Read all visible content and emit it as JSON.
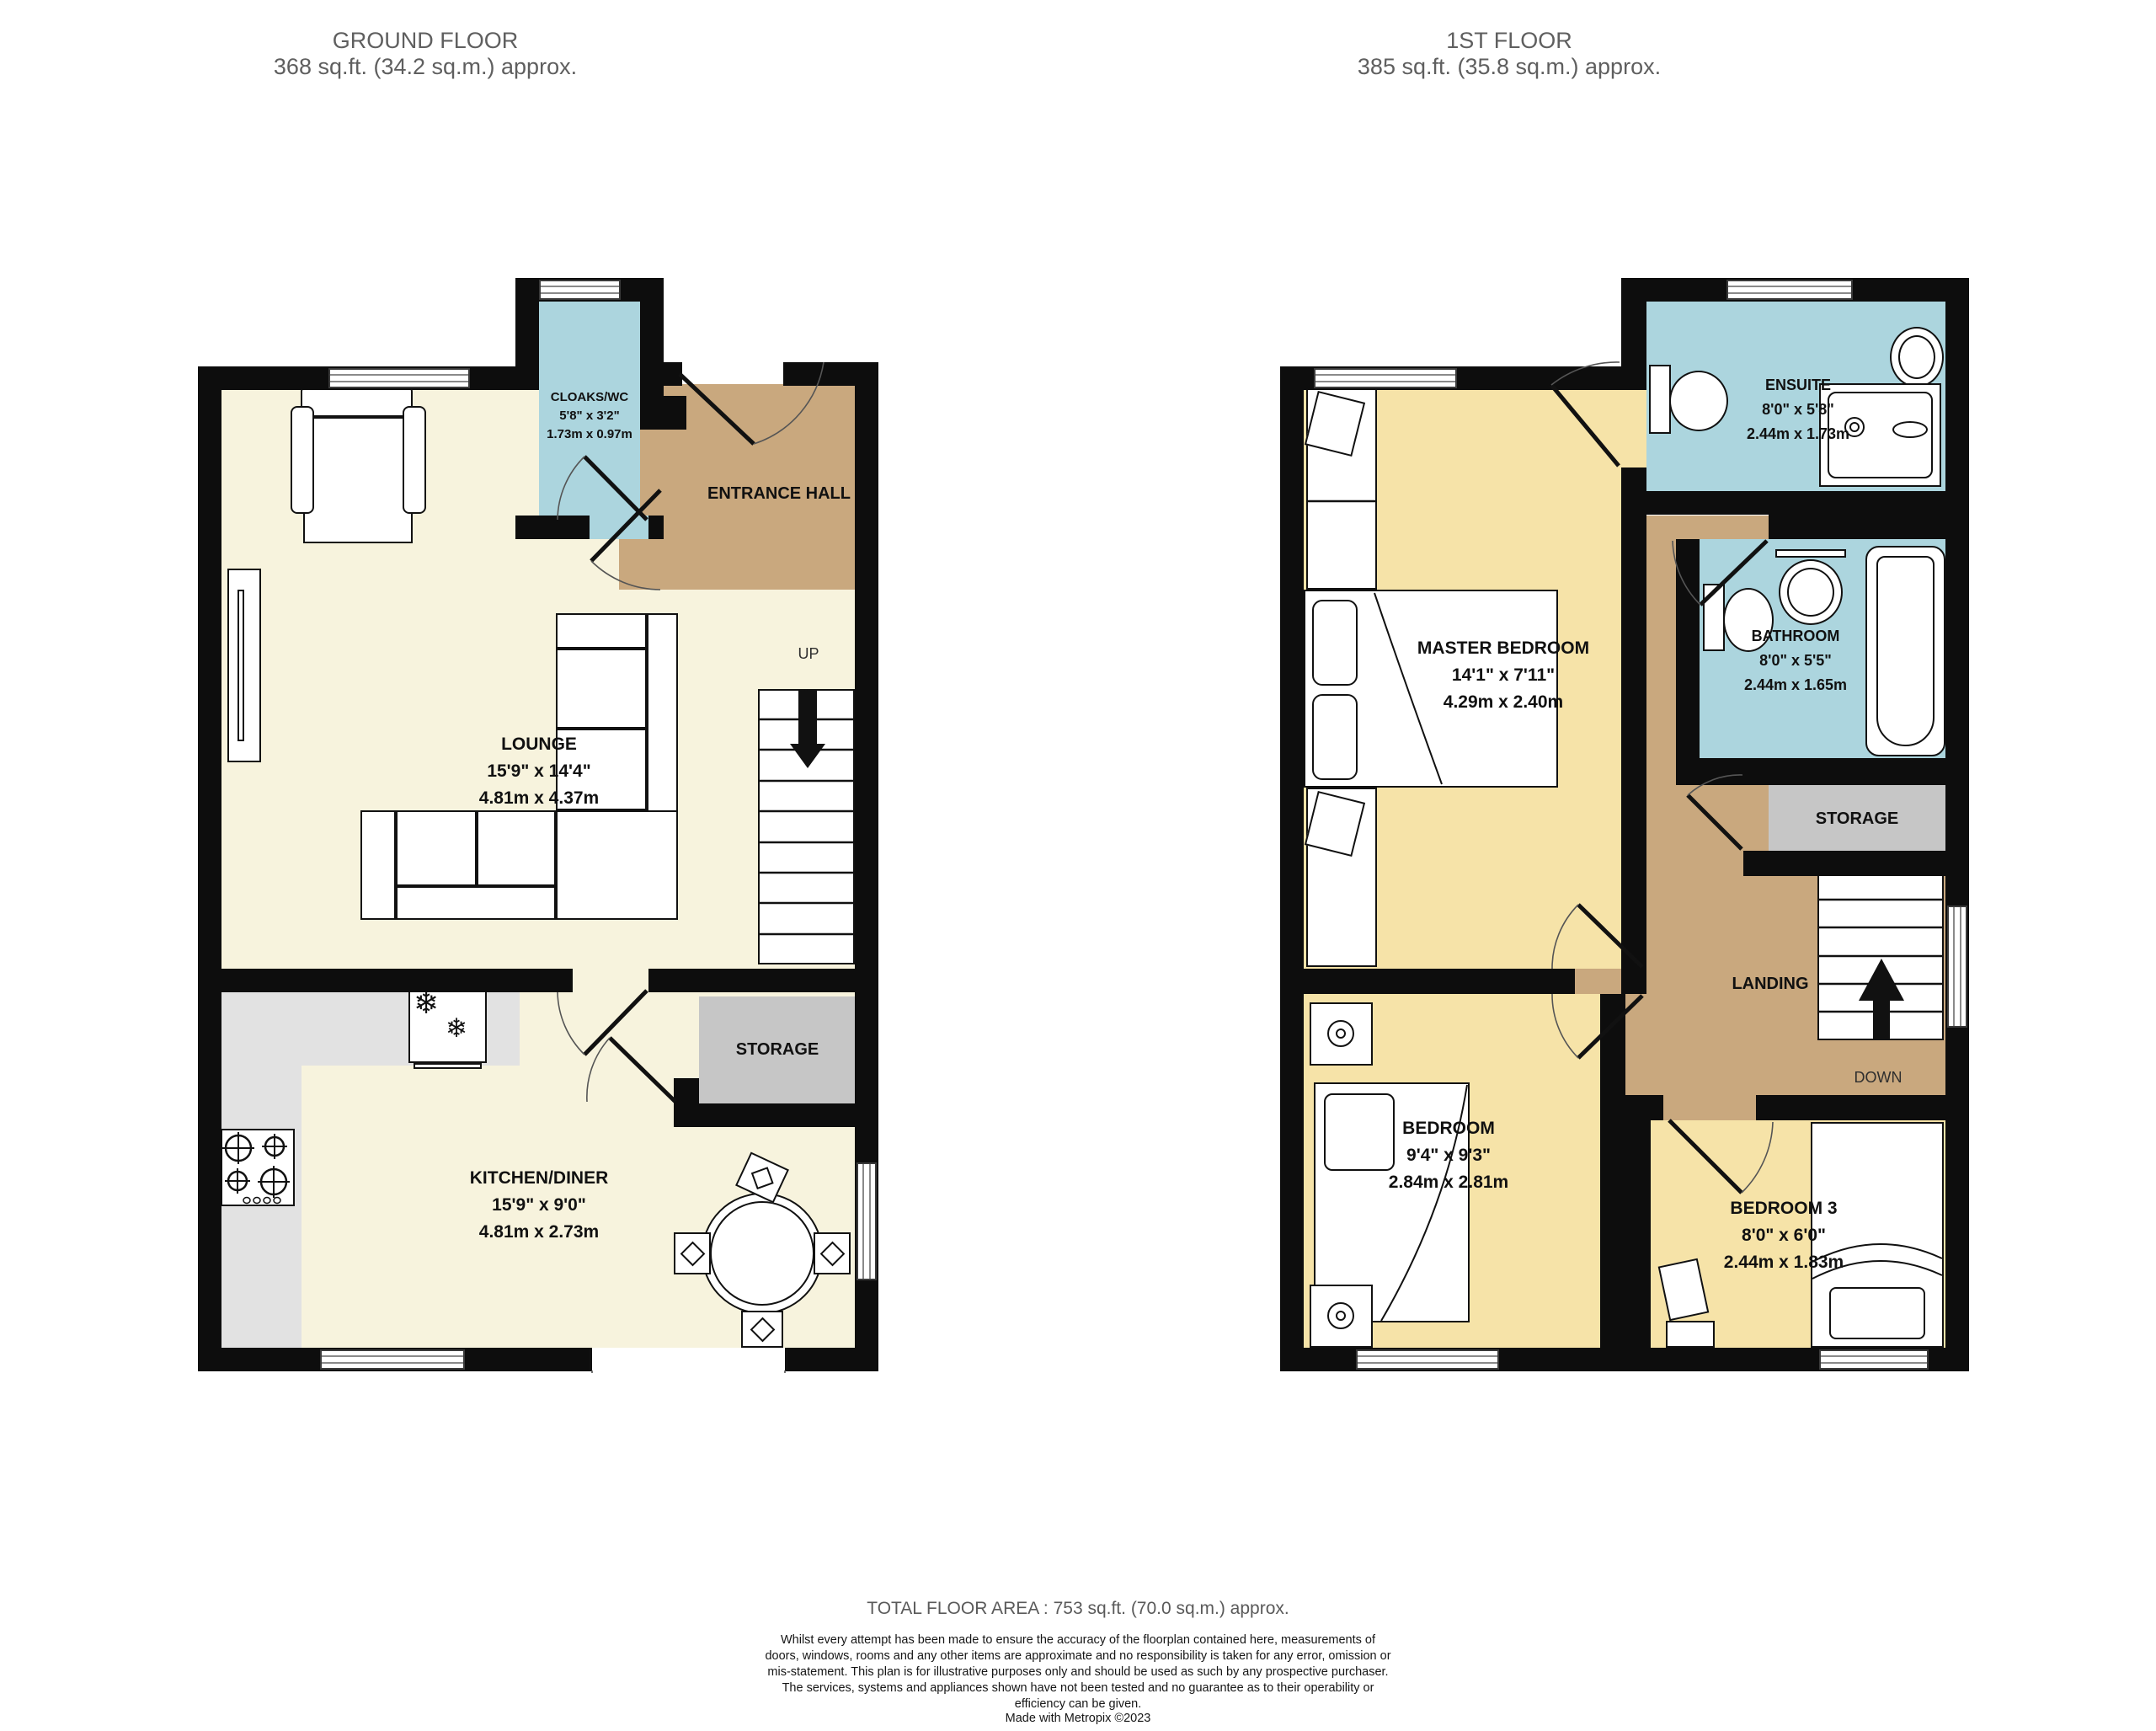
{
  "ground_floor": {
    "header": {
      "title": "GROUND FLOOR",
      "area": "368 sq.ft. (34.2 sq.m.) approx."
    },
    "lounge": {
      "name": "LOUNGE",
      "imperial": "15'9\" x 14'4\"",
      "metric": "4.81m x 4.37m"
    },
    "kitchen": {
      "name": "KITCHEN/DINER",
      "imperial": "15'9\" x 9'0\"",
      "metric": "4.81m x 2.73m"
    },
    "cloaks": {
      "name": "CLOAKS/WC",
      "imperial": "5'8\" x 3'2\"",
      "metric": "1.73m x 0.97m"
    },
    "entrance_hall": "ENTRANCE HALL",
    "storage": "STORAGE",
    "up": "UP"
  },
  "first_floor": {
    "header": {
      "title": "1ST FLOOR",
      "area": "385 sq.ft. (35.8 sq.m.) approx."
    },
    "master": {
      "name": "MASTER BEDROOM",
      "imperial": "14'1\" x 7'11\"",
      "metric": "4.29m x 2.40m"
    },
    "ensuite": {
      "name": "ENSUITE",
      "imperial": "8'0\" x 5'8\"",
      "metric": "2.44m x 1.73m"
    },
    "bathroom": {
      "name": "BATHROOM",
      "imperial": "8'0\" x 5'5\"",
      "metric": "2.44m x 1.65m"
    },
    "bedroom": {
      "name": "BEDROOM",
      "imperial": "9'4\" x 9'3\"",
      "metric": "2.84m x 2.81m"
    },
    "bedroom3": {
      "name": "BEDROOM 3",
      "imperial": "8'0\" x 6'0\"",
      "metric": "2.44m x 1.83m"
    },
    "storage": "STORAGE",
    "landing": "LANDING",
    "down": "DOWN"
  },
  "footer": {
    "total_area": "TOTAL FLOOR AREA : 753 sq.ft. (70.0 sq.m.) approx.",
    "disclaimer": "Whilst every attempt has been made to ensure the accuracy of the floorplan contained here, measurements of doors, windows, rooms and any other items are approximate and no responsibility is taken for any error, omission or mis-statement. This plan is for illustrative purposes only and should be used as such by any prospective purchaser. The services, systems and appliances shown have not been tested and no guarantee as to their operability or efficiency can be given.",
    "credit": "Made with Metropix ©2023"
  },
  "colors": {
    "cream": "#F7F3DD",
    "yellow": "#F6E3A8",
    "tan": "#C9A87E",
    "blue": "#ACD5DE",
    "storage": "#C6C6C6",
    "counter": "#E2E2E2"
  },
  "icons": {
    "snowflake": "❄"
  }
}
